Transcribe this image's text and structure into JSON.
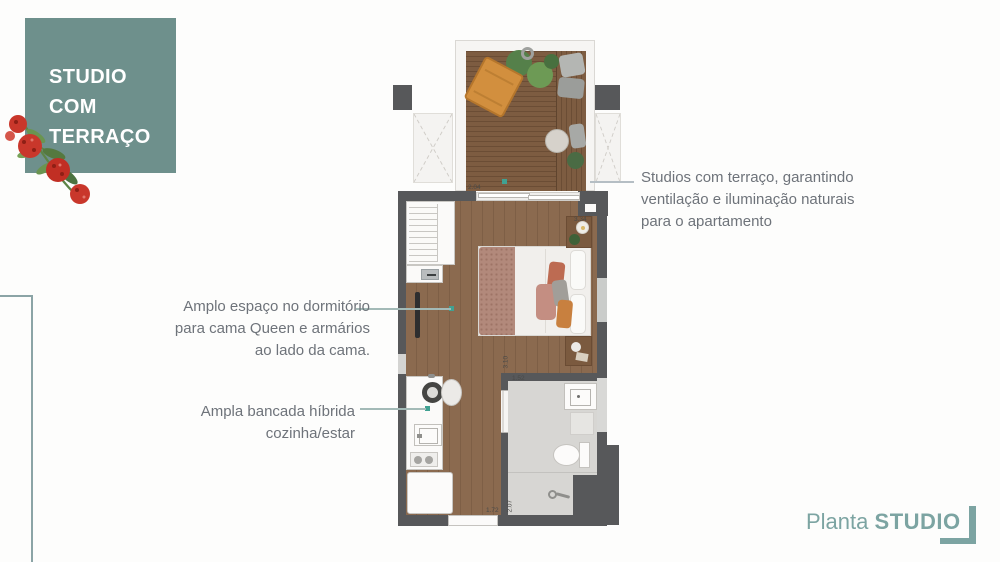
{
  "title_box": {
    "lines": [
      "STUDIO",
      "COM",
      "TERRAÇO"
    ]
  },
  "annotations": {
    "terrace": {
      "lines": [
        "Studios com terraço, garantindo",
        "ventilação e iluminação naturais",
        "para o apartamento"
      ]
    },
    "bedroom": {
      "lines": [
        "Amplo espaço no dormitório",
        "para cama Queen e armários",
        "ao lado da cama."
      ]
    },
    "kitchen": {
      "lines": [
        "Ampla bancada híbrida",
        "cozinha/estar"
      ]
    }
  },
  "floor_plan": {
    "dimensions": {
      "terrace_width": "2.04",
      "bedroom_width": "3.34",
      "bedroom_length": "3.10",
      "bathroom_width": "1.52",
      "bathroom_length": "2.07",
      "entry_width": "1.72"
    }
  },
  "footer": {
    "label_regular": "Planta",
    "label_bold": "STUDIO"
  },
  "colors": {
    "accent_teal": "#6e908c",
    "footer_teal": "#7ca4a2",
    "annotation_gray": "#6e737a",
    "wall_gray": "#57585a",
    "wood_floor": "#8b6a4f",
    "deck_wood": "#75543b",
    "marker_teal": "#40a192",
    "flower_red": "#c9372b",
    "leaf_green": "#5d8446"
  }
}
